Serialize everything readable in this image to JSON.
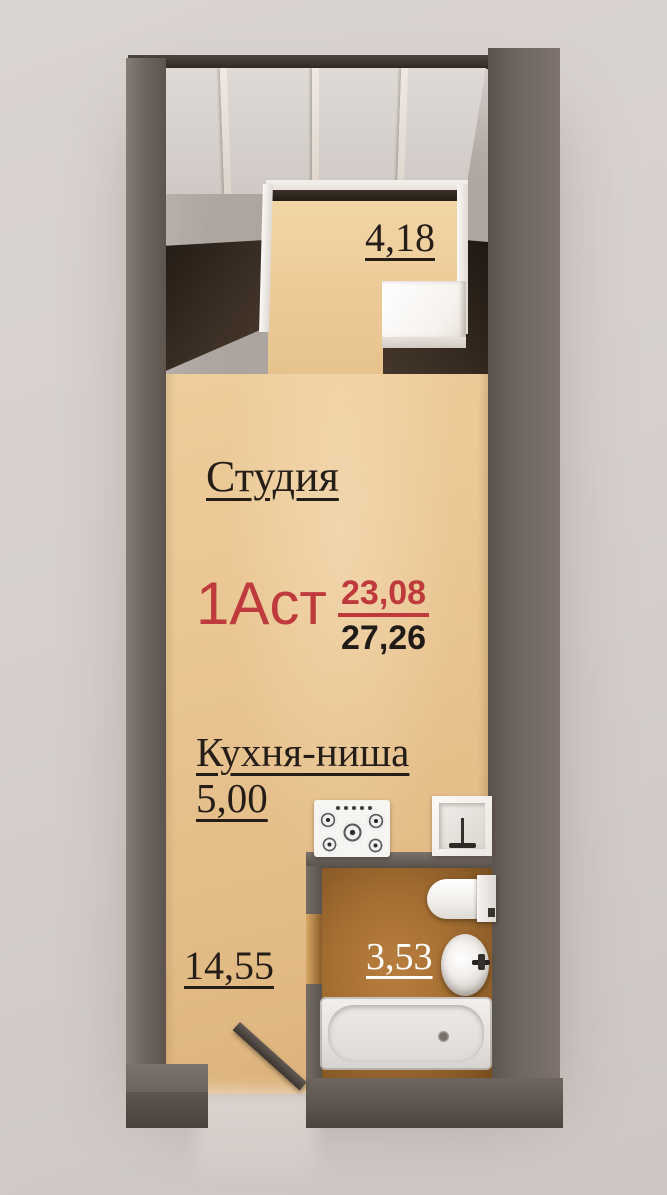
{
  "plan": {
    "unit": {
      "code": "1Аст",
      "living_area": "23,08",
      "total_area": "27,26"
    },
    "studio": {
      "name": "Студия",
      "area": "14,55"
    },
    "kitchen": {
      "name": "Кухня-ниша",
      "area": "5,00"
    },
    "bathroom": {
      "area": "3,53"
    },
    "balcony": {
      "area": "4,18"
    },
    "fixtures": [
      "stove",
      "kitchen-sink",
      "toilet",
      "washbasin",
      "bathtub",
      "entrance-door",
      "balcony-glazing"
    ],
    "colors": {
      "accent_red": "#bf3a3c",
      "text_black": "#241d18",
      "text_white": "#ffffff",
      "floor_tan": "#e8c38f",
      "bathroom_floor": "#a56f32",
      "wall_gray": "#6b625c",
      "dark_partition": "#2e241c",
      "white_partition": "#f5f2ef",
      "background": "#d6cfcc"
    }
  }
}
